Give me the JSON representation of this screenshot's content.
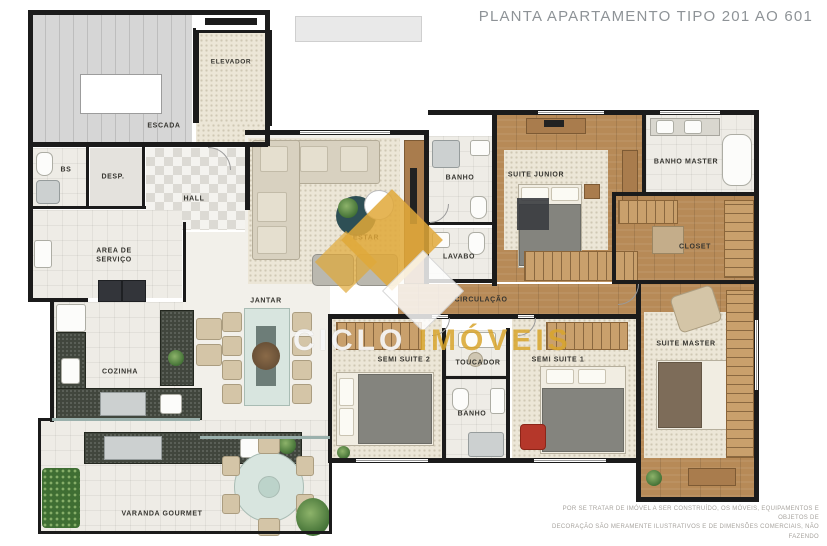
{
  "title": "PLANTA APARTAMENTO TIPO 201 AO 601",
  "watermark": {
    "word1": "CICLO",
    "word2": "IMÓVEIS"
  },
  "disclaimer": {
    "line1": "POR SE TRATAR DE IMÓVEL A SER CONSTRUÍDO, OS MÓVEIS, EQUIPAMENTOS E OBJETOS DE",
    "line2": "DECORAÇÃO SÃO MERAMENTE ILUSTRATIVOS E DE DIMENSÕES COMERCIAIS, NÃO FAZENDO"
  },
  "rooms": {
    "escada": "ESCADA",
    "elevador": "ELEVADOR",
    "hall": "HALL",
    "banho_servico": "BS",
    "desp": "DESP.",
    "area_servico": "AREA DE SERVIÇO",
    "cozinha": "COZINHA",
    "jantar": "JANTAR",
    "estar": "ESTAR",
    "banho_social": "BANHO",
    "lavabo": "LAVABO",
    "suite_junior": "SUITE JUNIOR",
    "banho_master": "BANHO MASTER",
    "closet": "CLOSET",
    "circulacao": "CIRCULAÇÃO",
    "semi_suite_2": "SEMI SUITE 2",
    "toucador": "TOUCADOR",
    "banho_semi": "BANHO",
    "semi_suite_1": "SEMI SUITE 1",
    "suite_master": "SUITE MASTER",
    "varanda_gourmet": "VARANDA GOURMET"
  },
  "colors": {
    "wall": "#1b1b1b",
    "accent_gold": "#d8a42c",
    "wood": "#b78a57"
  }
}
